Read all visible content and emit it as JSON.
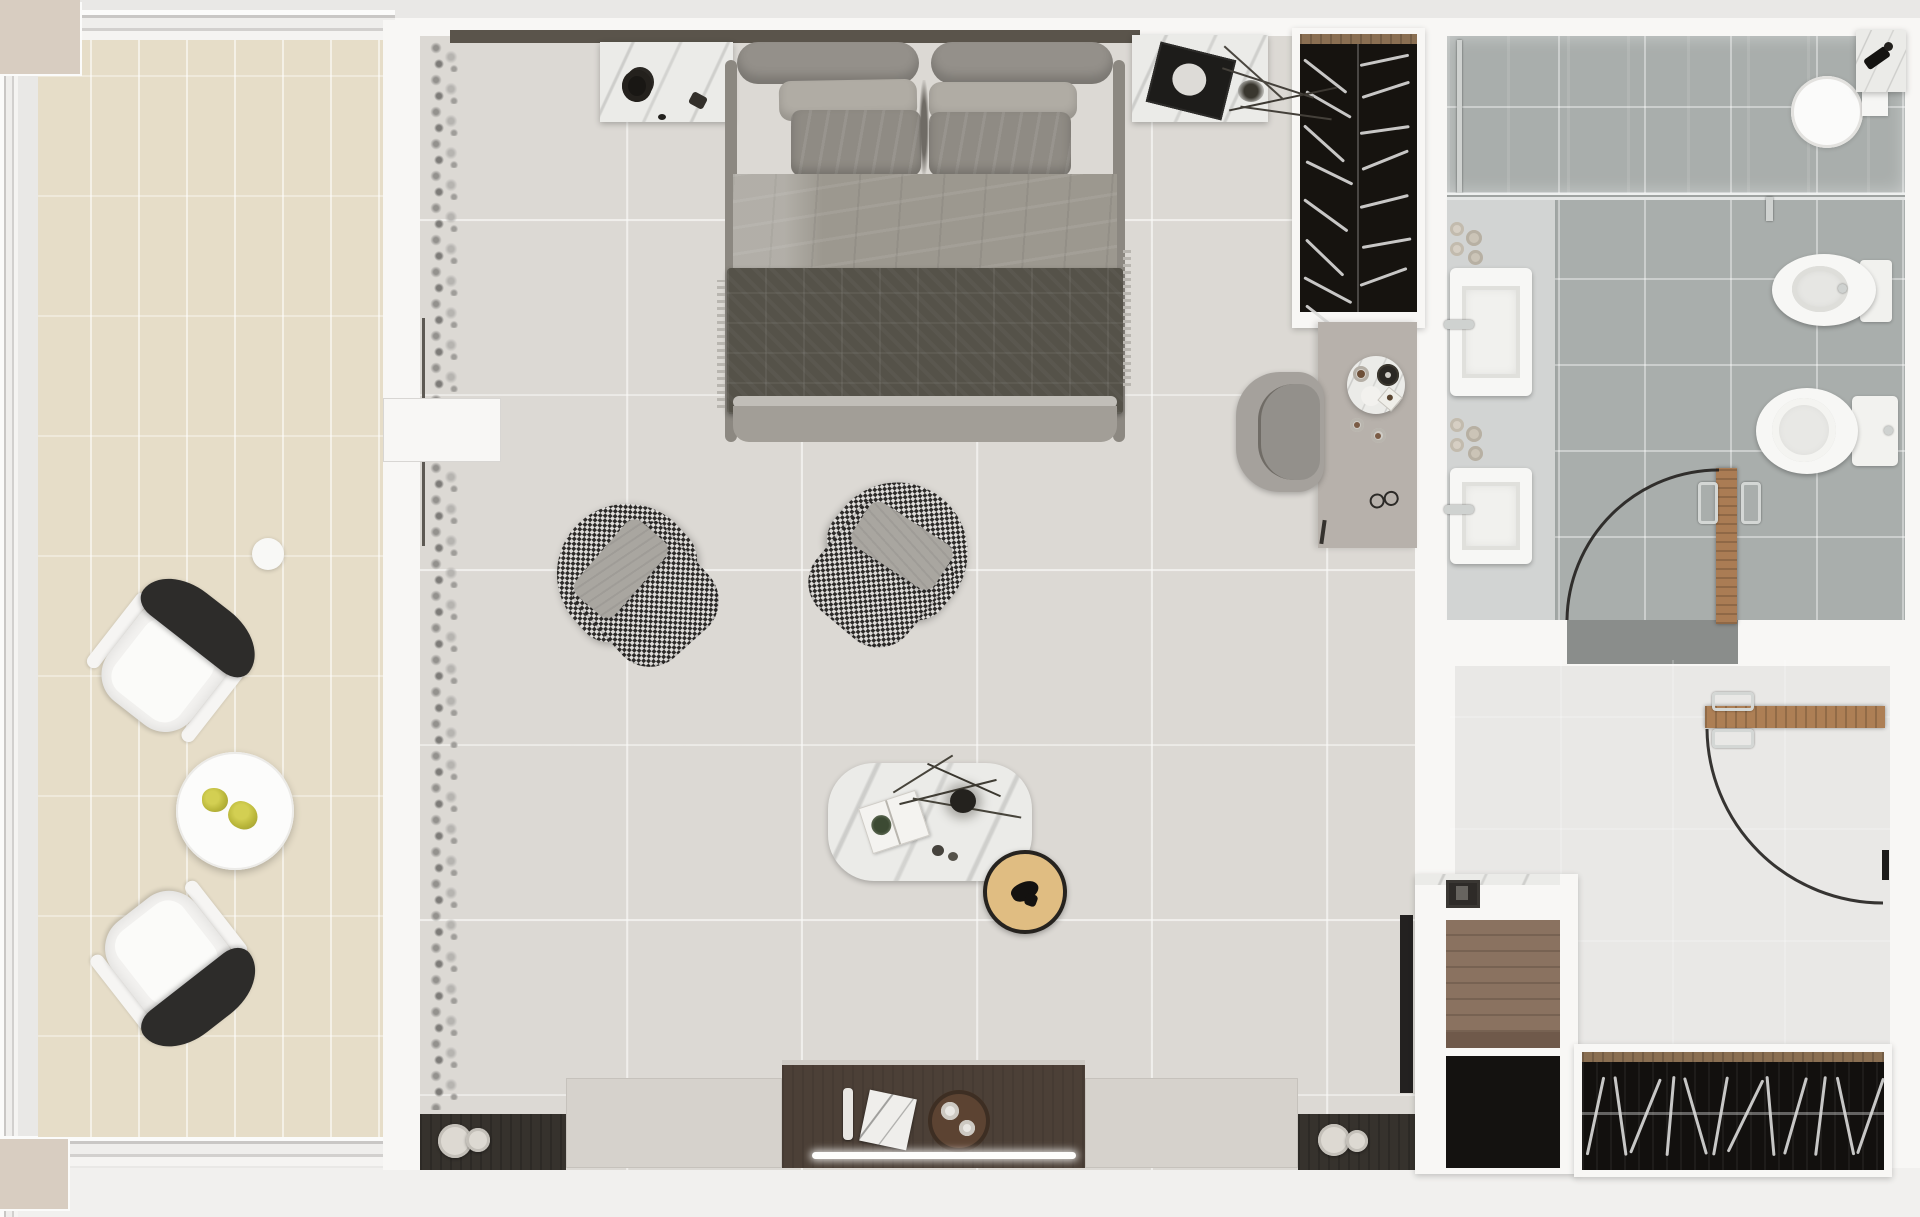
{
  "meta": {
    "title": "Top-down 3D rendered floor plan of a studio suite",
    "rooms_count": 4
  },
  "palette": {
    "outer": "#e9e8e6",
    "wall": "#f8f7f5",
    "roof-block": "#d8cdc1",
    "balcony-tile": "#e6ddc8",
    "bedroom-floor": "#dcd9d4",
    "bath-floor": "#a9aeac",
    "bath-vanity": "#d2d4d3",
    "shower-glass": "#c6ccc8",
    "entry-floor": "#8a8d8b",
    "closet-dark": "#12100e",
    "head-ledge": "#5a544b",
    "headboard": "#94908a",
    "pillow-back": "#b0aca4",
    "pillow-front": "#8f8b84",
    "duvet": "#9c988f",
    "throw": "#555249",
    "bed-frame": "#8c8881",
    "check-dark": "#2c2a28",
    "check-light": "#dedcd9",
    "ac-pillow": "#a9a6a0",
    "chair-back": "#2d2c2a",
    "plant-green": "#b9b63a",
    "console-wood": "#4c4037",
    "shelf-dark": "#36322d",
    "panel-beige": "#d6d2cc",
    "door-wood": "#aa7c54",
    "niche-wood": "#8a7260",
    "stool-top": "#e0bd82",
    "led": "#fdfdfc",
    "chrome": "#cfd2d0",
    "marble": "#ebebe8"
  },
  "rooms": {
    "balcony": {
      "name": "balcony",
      "items": [
        "lounge-chair",
        "lounge-chair",
        "round-side-table",
        "two-green-plants",
        "floor-light"
      ]
    },
    "bedroom": {
      "name": "bedroom",
      "items": [
        "double-bed",
        "nightstand-left",
        "nightstand-right",
        "open-wardrobe",
        "desk",
        "desk-chair",
        "armchair-left",
        "armchair-right",
        "marble-coffee-table",
        "round-stool",
        "media-console",
        "sheer-curtain"
      ]
    },
    "bathroom": {
      "name": "bathroom",
      "items": [
        "walk-in-shower",
        "shower-head",
        "double-sink-vanity",
        "bidet",
        "toilet",
        "wood-door-open"
      ]
    },
    "entry": {
      "name": "entry-hall",
      "items": [
        "entry-door-open",
        "storage-cabinet",
        "shoe-closet-with-hangers"
      ]
    }
  },
  "wardrobe_hangers": [
    {
      "x": 4,
      "y": 14,
      "angle": 38,
      "len": 54
    },
    {
      "x": 60,
      "y": 20,
      "angle": -12,
      "len": 50
    },
    {
      "x": 6,
      "y": 46,
      "angle": 30,
      "len": 52
    },
    {
      "x": 62,
      "y": 52,
      "angle": -18,
      "len": 50
    },
    {
      "x": 4,
      "y": 80,
      "angle": 42,
      "len": 54
    },
    {
      "x": 60,
      "y": 88,
      "angle": -8,
      "len": 50
    },
    {
      "x": 6,
      "y": 116,
      "angle": 26,
      "len": 52
    },
    {
      "x": 62,
      "y": 124,
      "angle": -22,
      "len": 50
    },
    {
      "x": 4,
      "y": 154,
      "angle": 36,
      "len": 54
    },
    {
      "x": 60,
      "y": 162,
      "angle": -14,
      "len": 50
    },
    {
      "x": 6,
      "y": 194,
      "angle": 44,
      "len": 52
    },
    {
      "x": 62,
      "y": 202,
      "angle": -10,
      "len": 50
    },
    {
      "x": 4,
      "y": 232,
      "angle": 28,
      "len": 54
    },
    {
      "x": 60,
      "y": 240,
      "angle": -20,
      "len": 50
    },
    {
      "x": 6,
      "y": 260,
      "angle": 38,
      "len": 52
    }
  ],
  "closet_hangers": [
    {
      "x": 12,
      "angle": 12
    },
    {
      "x": 37,
      "angle": -8
    },
    {
      "x": 62,
      "angle": 22
    },
    {
      "x": 87,
      "angle": 5
    },
    {
      "x": 112,
      "angle": -16
    },
    {
      "x": 137,
      "angle": 10
    },
    {
      "x": 162,
      "angle": 26
    },
    {
      "x": 187,
      "angle": -5
    },
    {
      "x": 212,
      "angle": 16
    },
    {
      "x": 237,
      "angle": 7
    },
    {
      "x": 262,
      "angle": -12
    },
    {
      "x": 287,
      "angle": 19
    }
  ]
}
